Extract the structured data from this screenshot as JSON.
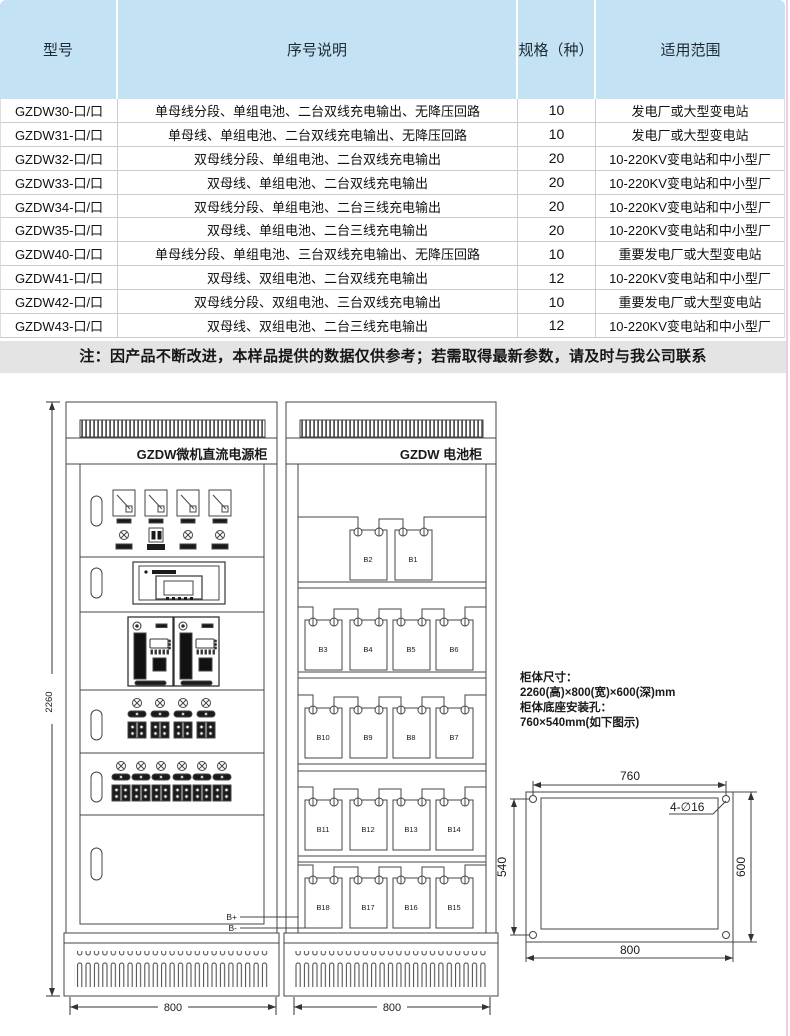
{
  "table": {
    "headers": [
      "型号",
      "序号说明",
      "规格（种）",
      "适用范围"
    ],
    "rows": [
      [
        "GZDW30-口/口",
        "单母线分段、单组电池、二台双线充电输出、无降压回路",
        "10",
        "发电厂或大型变电站"
      ],
      [
        "GZDW31-口/口",
        "单母线、单组电池、二台双线充电输出、无降压回路",
        "10",
        "发电厂或大型变电站"
      ],
      [
        "GZDW32-口/口",
        "双母线分段、单组电池、二台双线充电输出",
        "20",
        "10-220KV变电站和中小型厂"
      ],
      [
        "GZDW33-口/口",
        "双母线、单组电池、二台双线充电输出",
        "20",
        "10-220KV变电站和中小型厂"
      ],
      [
        "GZDW34-口/口",
        "双母线分段、单组电池、二台三线充电输出",
        "20",
        "10-220KV变电站和中小型厂"
      ],
      [
        "GZDW35-口/口",
        "双母线、单组电池、二台三线充电输出",
        "20",
        "10-220KV变电站和中小型厂"
      ],
      [
        "GZDW40-口/口",
        "单母线分段、单组电池、三台双线充电输出、无降压回路",
        "10",
        "重要发电厂或大型变电站"
      ],
      [
        "GZDW41-口/口",
        "双母线、双组电池、二台双线充电输出",
        "12",
        "10-220KV变电站和中小型厂"
      ],
      [
        "GZDW42-口/口",
        "双母线分段、双组电池、三台双线充电输出",
        "10",
        "重要发电厂或大型变电站"
      ],
      [
        "GZDW43-口/口",
        "双母线、双组电池、二台三线充电输出",
        "12",
        "10-220KV变电站和中小型厂"
      ]
    ]
  },
  "note": "注：因产品不断改进，本样品提供的数据仅供参考；若需取得最新参数，请及时与我公司联系",
  "colors": {
    "header_bg": "#c3e2f4",
    "note_bg": "#e4e4e4",
    "line": "#444444"
  },
  "diagram": {
    "power_cabinet": {
      "title": "GZDW微机直流电源柜",
      "width_dim": "800"
    },
    "battery_cabinet": {
      "title": "GZDW 电池柜",
      "width_dim": "800",
      "terminal_pos": "B+",
      "terminal_neg": "B-",
      "rows": [
        [
          "B2",
          "B1"
        ],
        [
          "B3",
          "B4",
          "B5",
          "B6"
        ],
        [
          "B10",
          "B9",
          "B8",
          "B7"
        ],
        [
          "B11",
          "B12",
          "B13",
          "B14"
        ],
        [
          "B18",
          "B17",
          "B16",
          "B15"
        ]
      ]
    },
    "height_dim": "2260",
    "specs": [
      "柜体尺寸：",
      "2260(高)×800(宽)×600(深)mm",
      "柜体底座安装孔：",
      "760×540mm(如下图示)"
    ],
    "mounting": {
      "dim_top": "760",
      "dim_left": "540",
      "dim_right": "600",
      "dim_bottom": "800",
      "holes_label": "4-∅16"
    }
  }
}
